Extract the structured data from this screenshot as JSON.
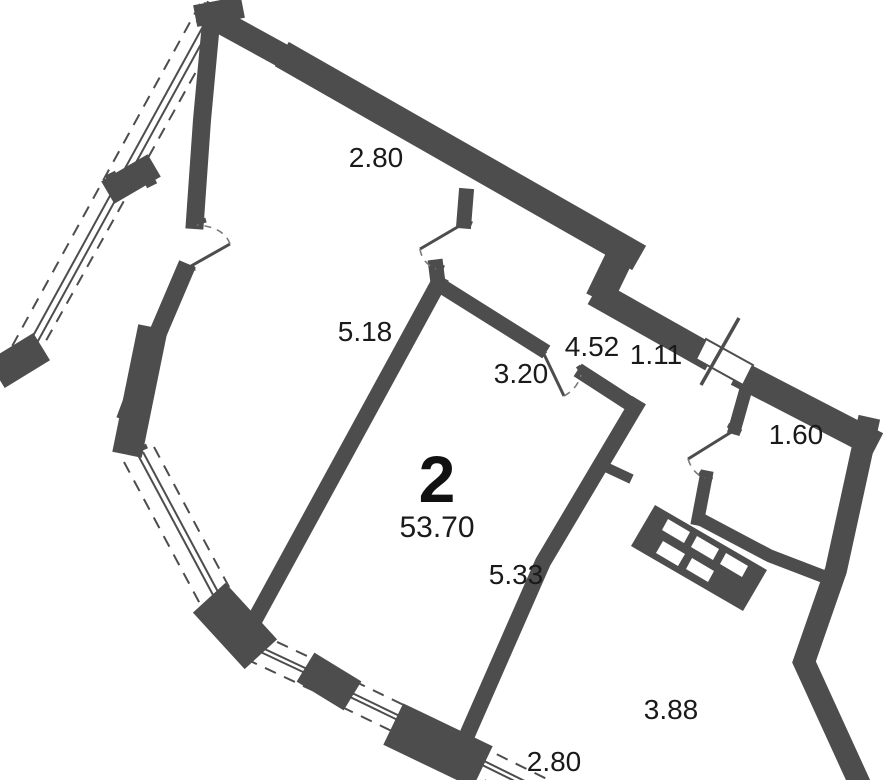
{
  "plan": {
    "rooms_count": "2",
    "total_area": "53.70",
    "dimensions": {
      "top_wall": "2.80",
      "left_room_side": "5.18",
      "center_room_width": "3.20",
      "hallway_length": "4.52",
      "hallway_width": "1.11",
      "bathroom_width": "1.60",
      "center_room_length": "5.33",
      "right_room_length": "3.88",
      "bottom_wall": "2.80"
    },
    "colors": {
      "wall": "#4d4d4d",
      "text": "#1a1a1a",
      "background": "#ffffff",
      "swing_arc": "#7a7a7a"
    }
  }
}
